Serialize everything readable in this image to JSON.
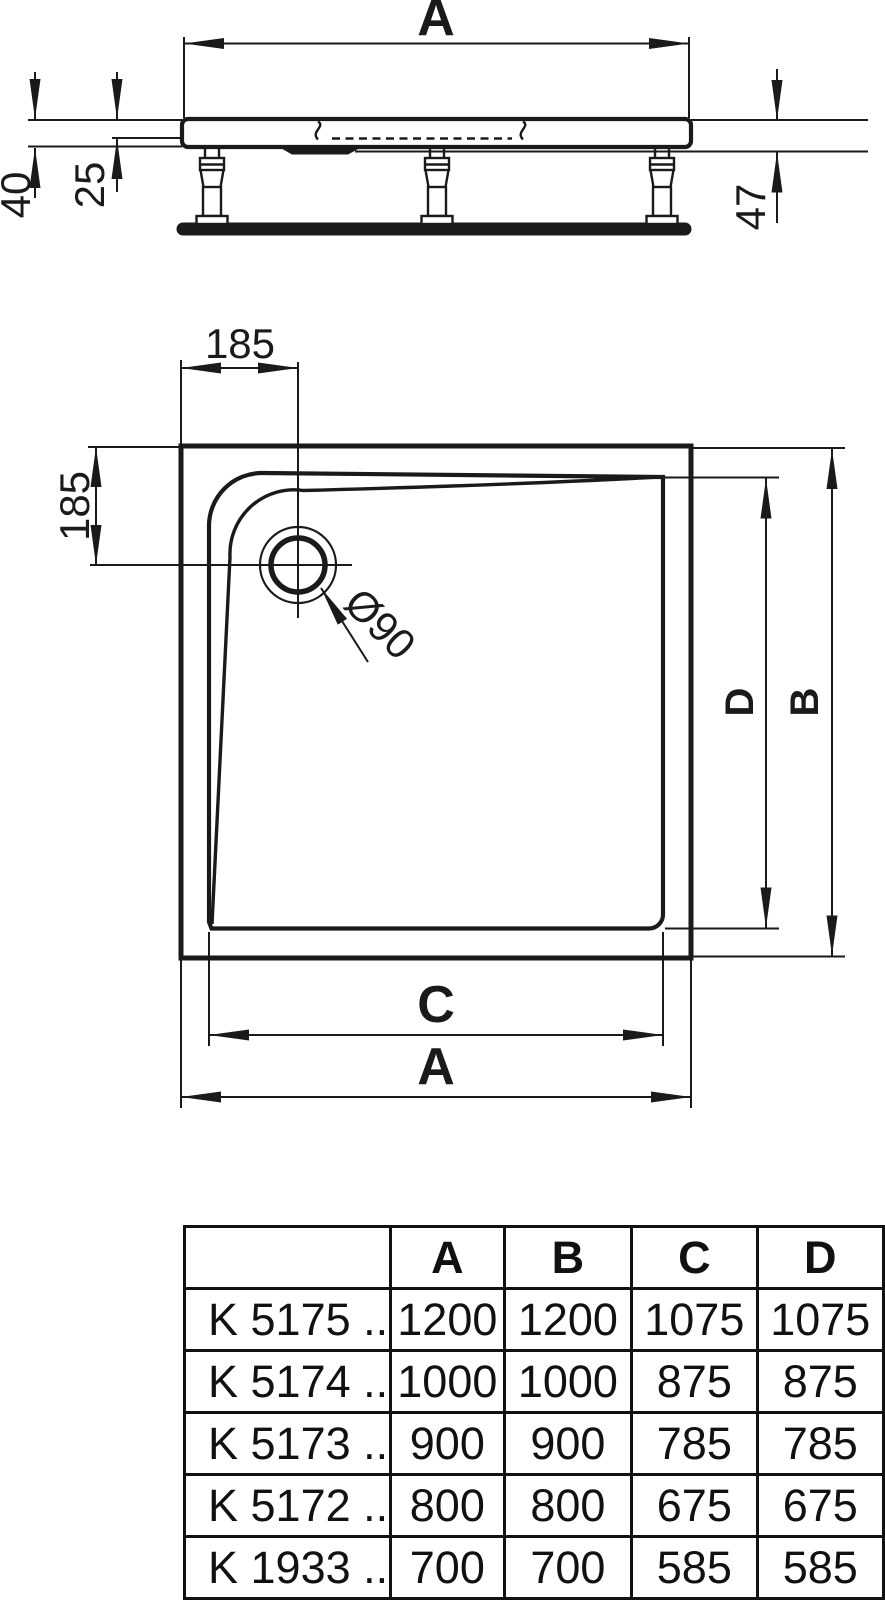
{
  "colors": {
    "ink": "#1a1a1a",
    "paper": "#ffffff"
  },
  "side_view": {
    "width_label": "A",
    "edge_height": "40",
    "inner_depth": "25",
    "frame_height": "47"
  },
  "plan_view": {
    "drain_offset_top": "185",
    "drain_offset_left": "185",
    "drain_diameter": "Ø90",
    "inner_width_label": "C",
    "outer_width_label": "A",
    "inner_depth_label": "D",
    "outer_depth_label": "B"
  },
  "table": {
    "headers": [
      "",
      "A",
      "B",
      "C",
      "D"
    ],
    "rows": [
      {
        "model": "K 5175 ..",
        "a": "1200",
        "b": "1200",
        "c": "1075",
        "d": "1075"
      },
      {
        "model": "K 5174 ..",
        "a": "1000",
        "b": "1000",
        "c": "875",
        "d": "875"
      },
      {
        "model": "K 5173 ..",
        "a": "900",
        "b": "900",
        "c": "785",
        "d": "785"
      },
      {
        "model": "K 5172 ..",
        "a": "800",
        "b": "800",
        "c": "675",
        "d": "675"
      },
      {
        "model": "K 1933 ..",
        "a": "700",
        "b": "700",
        "c": "585",
        "d": "585"
      }
    ]
  }
}
